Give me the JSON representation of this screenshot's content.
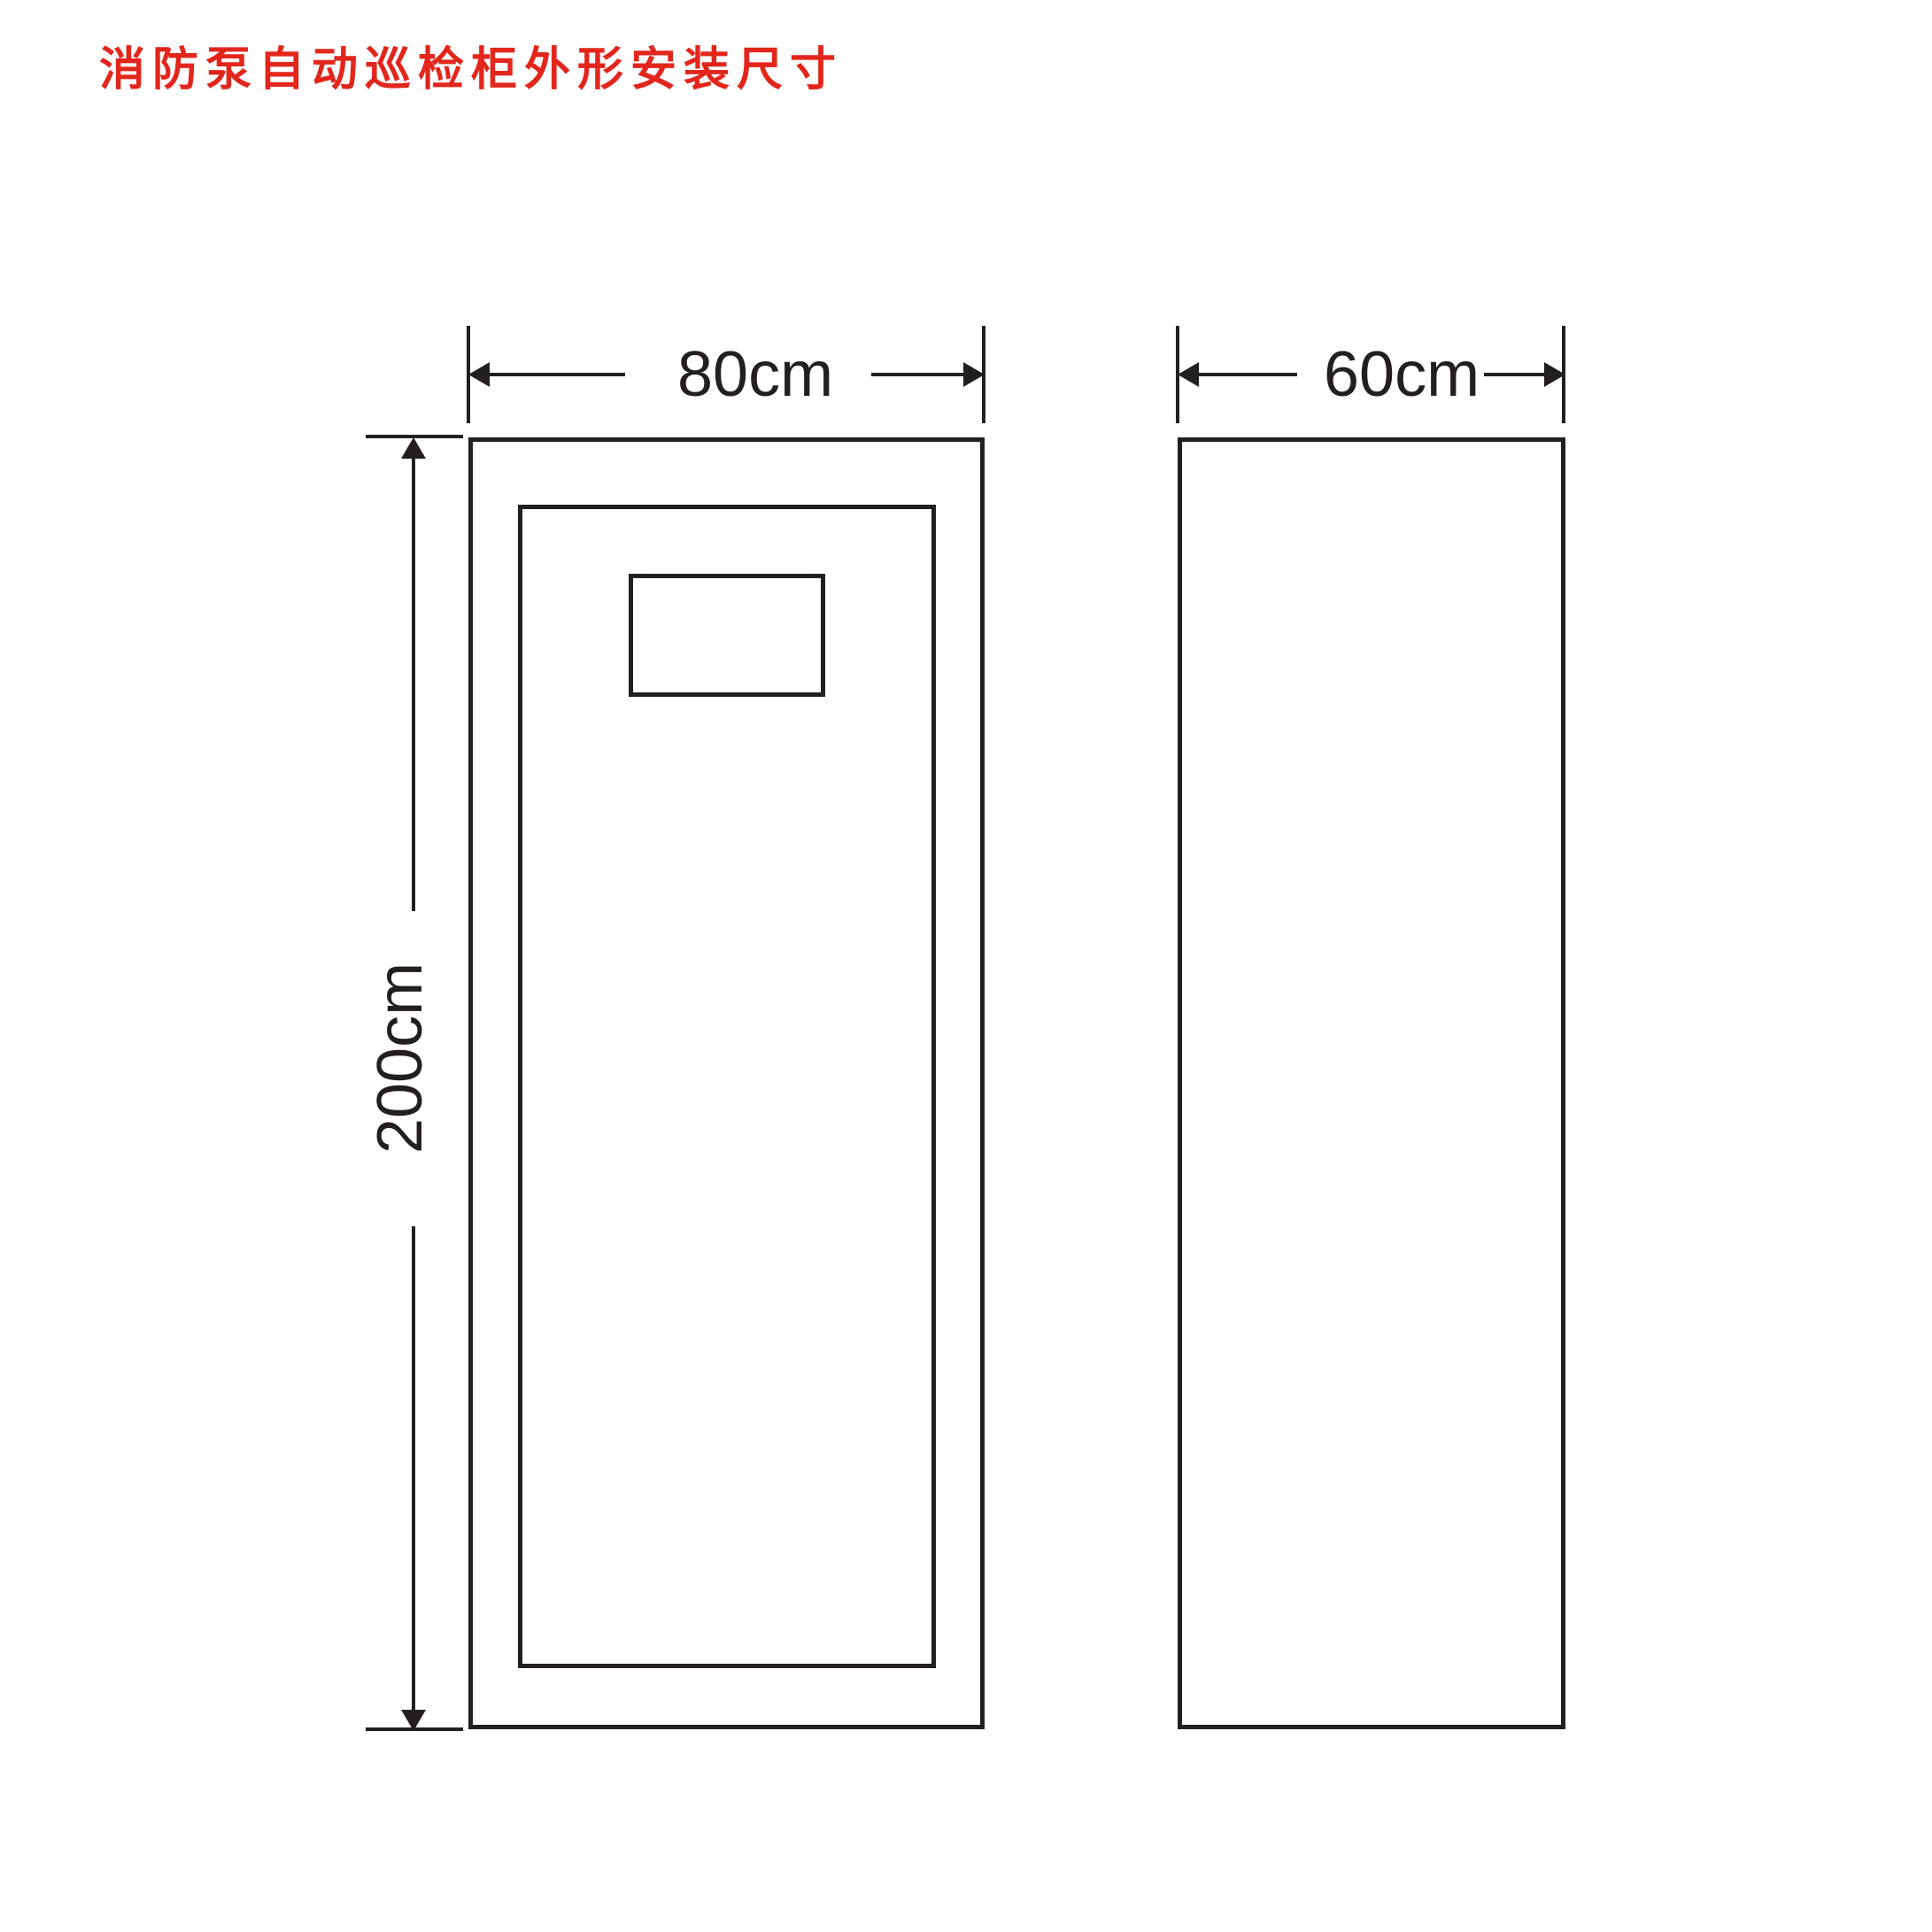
{
  "title": "消防泵自动巡检柜外形安装尺寸",
  "colors": {
    "accent_red": "#e2261c",
    "line_black": "#231f20",
    "background": "#ffffff"
  },
  "dimensions": {
    "front_width": {
      "label": "80cm",
      "orientation": "horizontal"
    },
    "side_width": {
      "label": "60cm",
      "orientation": "horizontal"
    },
    "cabinet_height": {
      "label": "200cm",
      "orientation": "vertical"
    }
  }
}
